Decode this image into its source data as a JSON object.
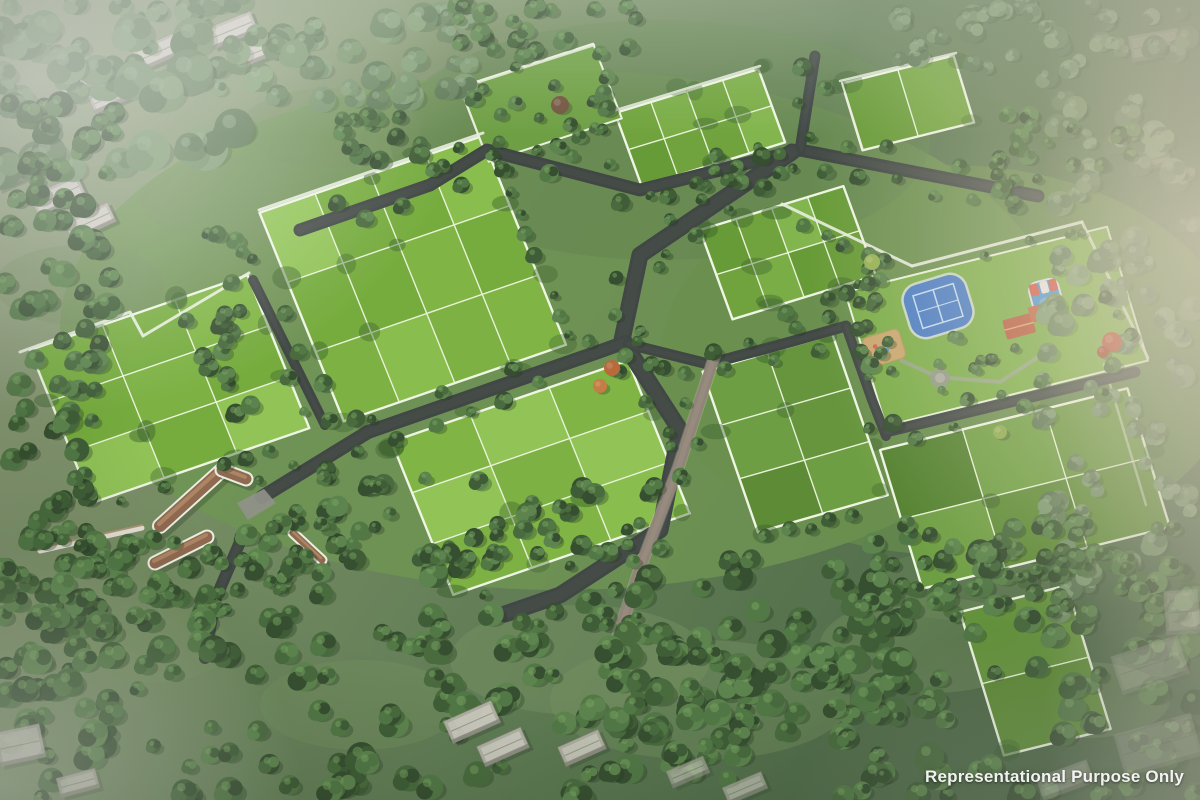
{
  "image": {
    "watermark": "Representational Purpose Only"
  },
  "palette": {
    "plot_green": "#7ab23b",
    "plot_line": "#e8f3d8",
    "road_dark": "#363d3a",
    "paver_brown": "#6f6152",
    "wall_white": "#e9eee0",
    "forest_green": "#3a5a31",
    "court_blue": "#3d74c4",
    "pool_blue": "#3f8ed0",
    "roof_orange": "#c05a38",
    "gate_roof_tan": "#8a6147",
    "sand_tan": "#c7a266",
    "building_gray": "#b6b2a8",
    "haze_warm": "#eadfc6",
    "haze_white": "#ffffff"
  }
}
